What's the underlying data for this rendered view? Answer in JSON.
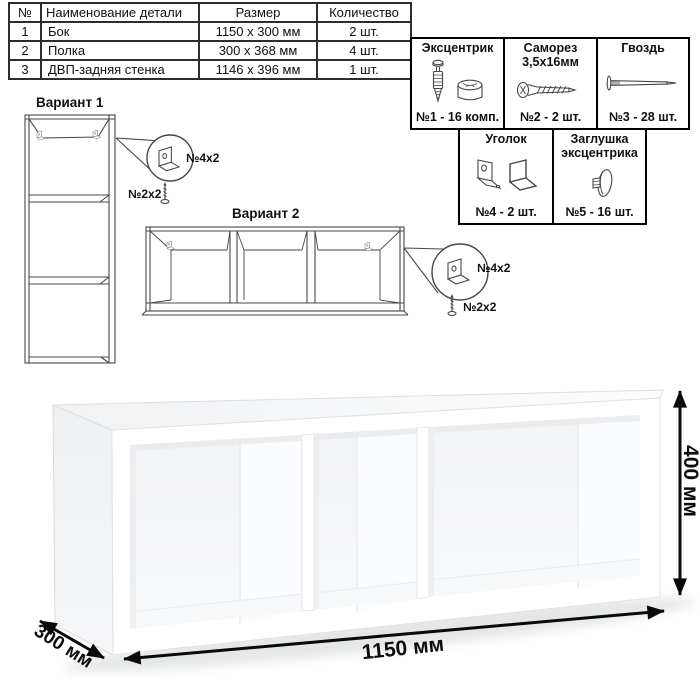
{
  "parts_table": {
    "headers": [
      "№",
      "Наименование детали",
      "Размер",
      "Количество"
    ],
    "rows": [
      {
        "num": "1",
        "name": "Бок",
        "size": "1150 x 300 мм",
        "qty": "2 шт."
      },
      {
        "num": "2",
        "name": "Полка",
        "size": "300 x 368 мм",
        "qty": "4 шт."
      },
      {
        "num": "3",
        "name": "ДВП-задняя стенка",
        "size": "1146 x 396 мм",
        "qty": "1 шт."
      }
    ]
  },
  "hardware": {
    "cells": [
      {
        "title": "Эксцентрик",
        "title2": "",
        "count": "№1 - 16 комп.",
        "icon": "cam-bolt-and-lock-icon"
      },
      {
        "title": "Саморез",
        "title2": "3,5х16мм",
        "count": "№2 - 2 шт.",
        "icon": "screw-icon"
      },
      {
        "title": "Гвоздь",
        "title2": "",
        "count": "№3 - 28 шт.",
        "icon": "nail-icon"
      },
      {
        "title": "Уголок",
        "title2": "",
        "count": "№4 - 2 шт.",
        "icon": "corner-bracket-icon"
      },
      {
        "title": "Заглушка",
        "title2": "эксцентрика",
        "count": "№5 - 16 шт.",
        "icon": "cam-cap-icon"
      }
    ]
  },
  "variants": {
    "v1": {
      "label": "Вариант 1",
      "bracket_label": "№4х2",
      "screw_label": "№2х2"
    },
    "v2": {
      "label": "Вариант 2",
      "bracket_label": "№4х2",
      "screw_label": "№2х2"
    }
  },
  "dimensions": {
    "width": "1150 мм",
    "height": "400 мм",
    "depth": "300 мм"
  },
  "colors": {
    "line": "#474747",
    "text": "#111111",
    "arrow": "#0a0a0a"
  }
}
